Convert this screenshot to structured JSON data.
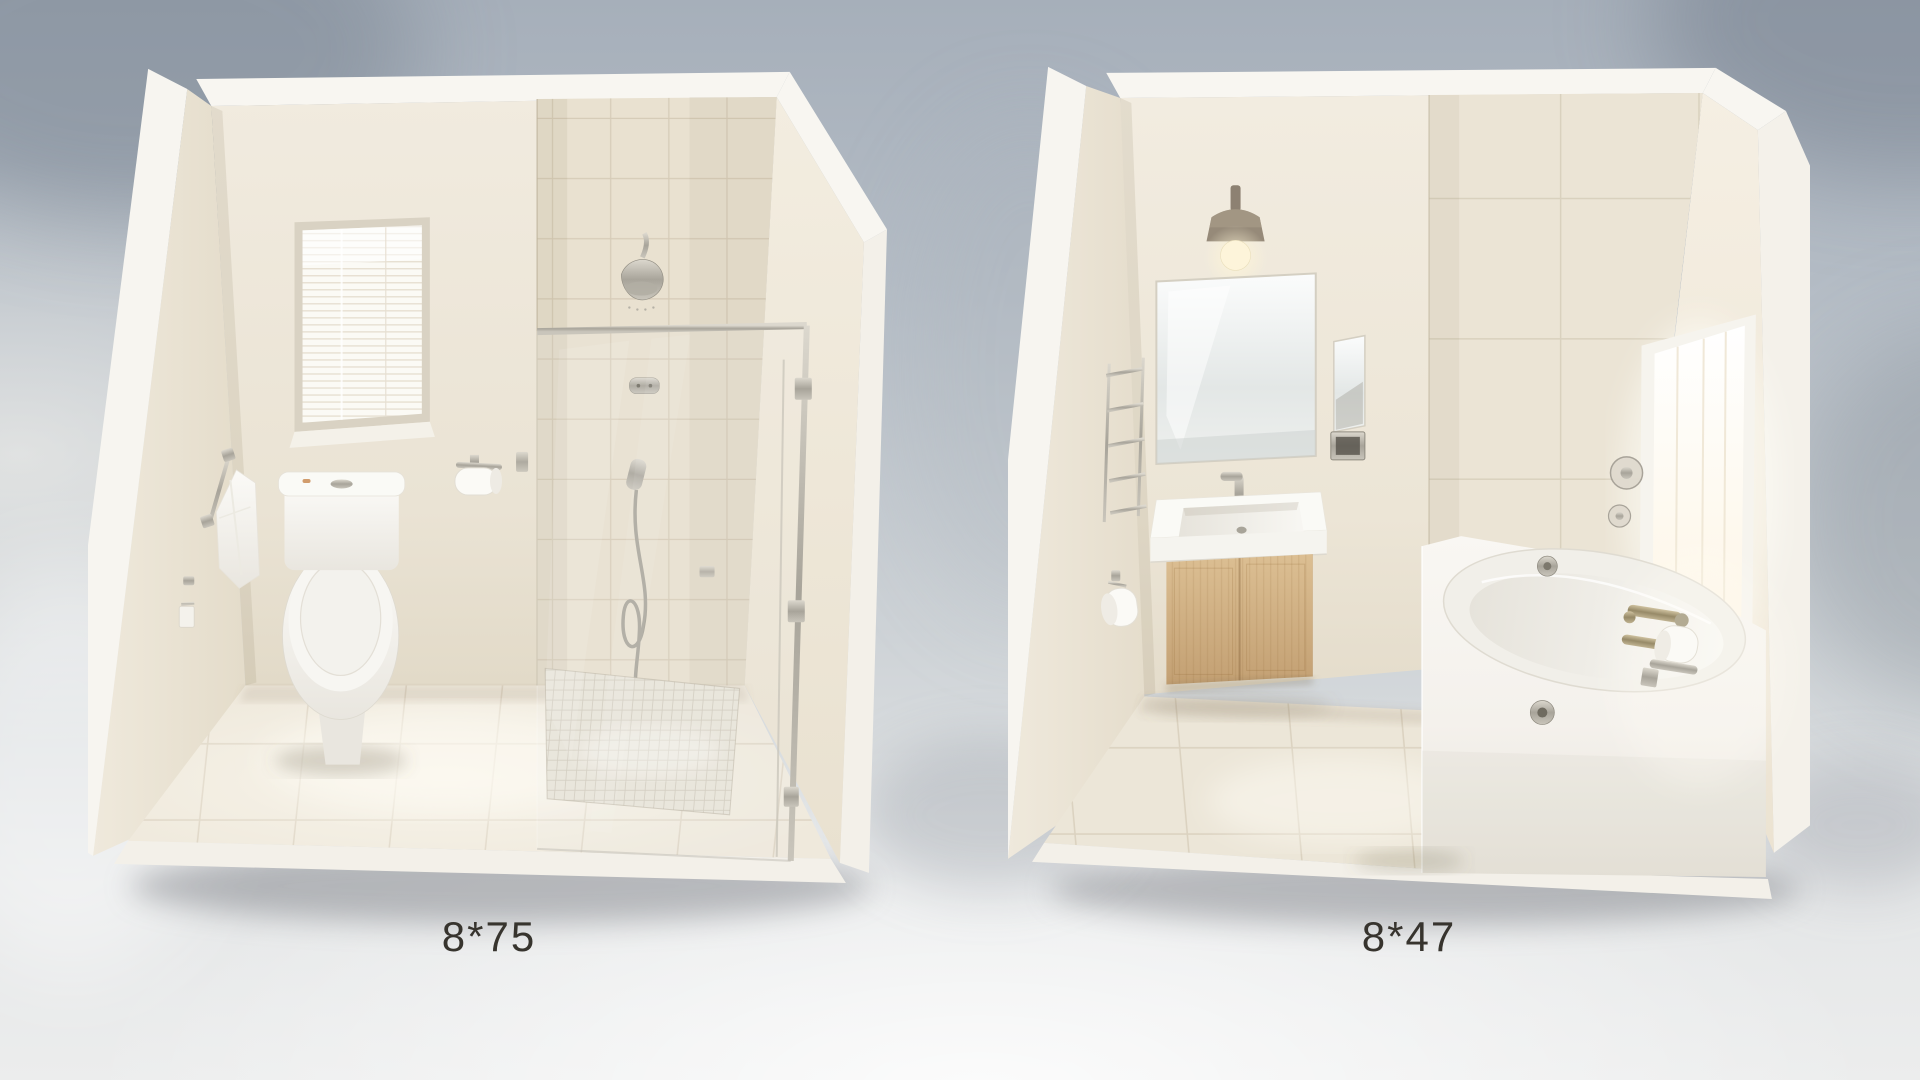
{
  "scene": {
    "description": "Two 3D rendered isometric bathroom layout dioramas side by side on a soft blue-gray studio backdrop with blurred foliage shadows",
    "background_top": "#a6afba",
    "background_bottom": "#eceded"
  },
  "rooms": [
    {
      "id": "left",
      "label": "8*75",
      "layout": "corner cutaway room with toilet on the left and a walk-in glass shower on the right",
      "fixtures": [
        "window with white venetian blinds",
        "two-piece white toilet",
        "chrome towel bar with white towel",
        "chrome wall hook with cloth",
        "chrome toilet paper holder with white roll",
        "beige tiled shower wall",
        "chrome shower head",
        "shower mixing valve",
        "hand shower with coiled hose",
        "framed glass shower enclosure with hinged door",
        "mosaic shower floor",
        "cream ceramic tile floor"
      ]
    },
    {
      "id": "right",
      "label": "8*47",
      "layout": "corner cutaway room with floating vanity on the left and bathtub under a bright window on the right",
      "fixtures": [
        "bronze wall sconce with glowing bulb",
        "large frameless vanity mirror",
        "narrow side mirror",
        "recessed chrome wall box",
        "chrome basin faucet",
        "white rectangular basin countertop",
        "floating light-oak two-door vanity cabinet",
        "chrome towel ladder rack",
        "toilet paper roll on left wall",
        "white apron-front bathtub",
        "chrome tub overflow and drain",
        "brushed-brass wall-mounted tub spout and handle",
        "toilet paper roll beside tub faucet",
        "two round chrome valve trims on tiled wall",
        "bright daylight window on right wall",
        "beige tiled accent wall",
        "beige ceramic tile floor"
      ]
    }
  ],
  "palette": {
    "wall_cream": "#ece5d7",
    "tile_beige": "#e9e1d1",
    "floor_tile": "#eee8db",
    "fixture_white": "#f8f6f2",
    "chrome": "#b9b5ab",
    "brass": "#b1a384",
    "wood_light_oak": "#d2b286",
    "sconce_shade": "#8d8172",
    "label_text": "#37342e"
  }
}
